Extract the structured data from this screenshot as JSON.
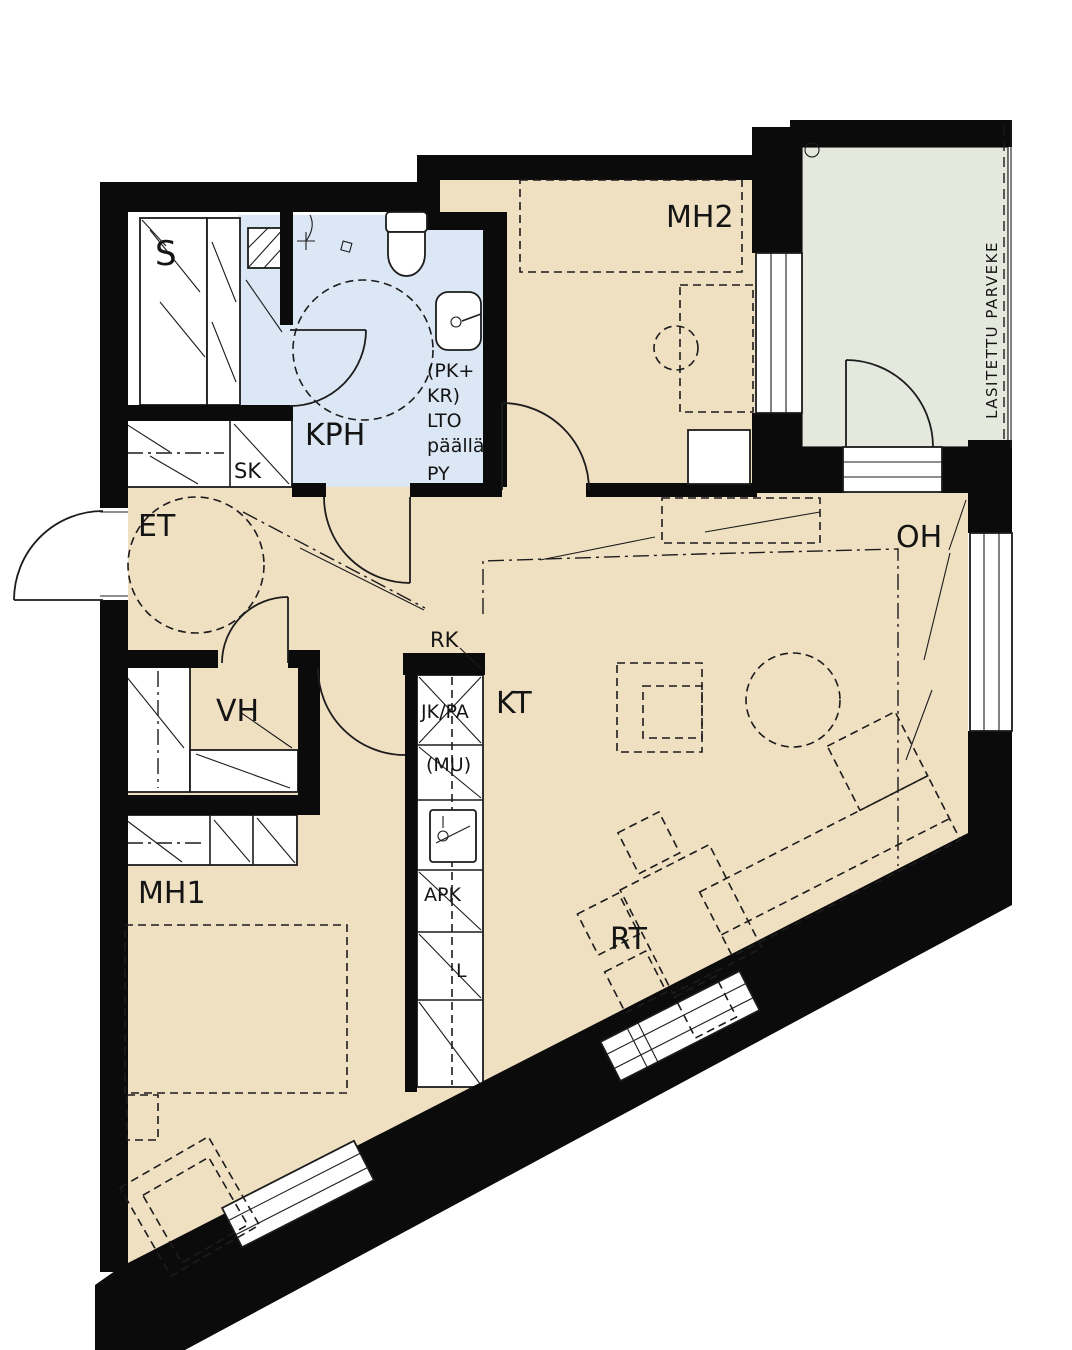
{
  "plan": {
    "title": "apartment-floor-plan",
    "rooms": {
      "sauna": "S",
      "bathroom": "KPH",
      "cleaning_closet": "SK",
      "bedroom2": "MH2",
      "balcony": "LASITETTU PARVEKE",
      "entry": "ET",
      "living": "OH",
      "walkin_closet": "VH",
      "kitchen": "KT",
      "bedroom1": "MH1",
      "dining": "RT"
    },
    "kitchen_labels": {
      "rk": "RK",
      "fridge": "JK/PA",
      "mu": "(MU)",
      "dishwasher": "APK",
      "stove": "L"
    },
    "bath_labels": {
      "pk": "(PK+",
      "kr": "KR)",
      "lto": "LTO",
      "paalla": "päällä",
      "py": "PY"
    },
    "colors": {
      "floor": "#f0e0c2",
      "wet_floor": "#dbe7f4",
      "balcony_floor": "#e4e8dd",
      "wall": "#0b0b0b",
      "line": "#1c1c1c"
    }
  }
}
